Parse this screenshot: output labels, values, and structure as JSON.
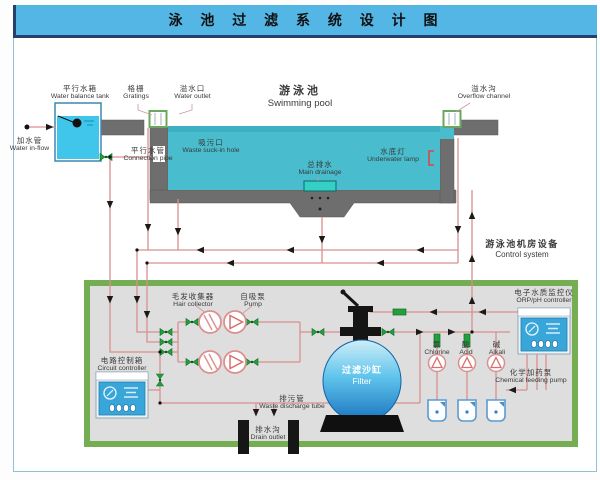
{
  "title": "泳 池 过 滤 系 统 设 计 图",
  "labels": {
    "balance_tank": {
      "cn": "平行水箱",
      "en": "Water balance tank"
    },
    "water_inflow": {
      "cn": "加水管",
      "en": "Water in-flow"
    },
    "gratings": {
      "cn": "格栅",
      "en": "Gratings"
    },
    "water_outlet": {
      "cn": "溢水口",
      "en": "Water outlet"
    },
    "swimming_pool": {
      "cn": "游泳池",
      "en": "Swimming pool"
    },
    "overflow_channel": {
      "cn": "溢水沟",
      "en": "Overflow channel"
    },
    "waste_suckin": {
      "cn": "吸污口",
      "en": "Waste suck-in hole"
    },
    "connection_pipe": {
      "cn": "平行水管",
      "en": "Connection pipe"
    },
    "main_drainage": {
      "cn": "总排水",
      "en": "Main drainage"
    },
    "underwater_lamp": {
      "cn": "水底灯",
      "en": "Underwater lamp"
    },
    "control_system": {
      "cn": "游泳池机房设备",
      "en": "Control system"
    },
    "hair_collector": {
      "cn": "毛发收集器",
      "en": "Hair collector"
    },
    "pump": {
      "cn": "自吸泵",
      "en": "Pump"
    },
    "circuit_controller": {
      "cn": "电路控制箱",
      "en": "Circuit controller"
    },
    "filter": {
      "cn": "过滤沙缸",
      "en": "Filter"
    },
    "chlorine": {
      "cn": "氯",
      "en": "Chlorine"
    },
    "acid": {
      "cn": "酸",
      "en": "Acid"
    },
    "alkali": {
      "cn": "碱",
      "en": "Alkali"
    },
    "chemical_feeding_pump": {
      "cn": "化学加药泵",
      "en": "Chemical feeding pump"
    },
    "orp_controller": {
      "cn": "电子水质监控仪",
      "en": "ORP/pH controller"
    },
    "waste_discharge": {
      "cn": "排污管",
      "en": "Waste discharge tube"
    },
    "drain_outlet": {
      "cn": "排水沟",
      "en": "Drain outlet"
    }
  },
  "colors": {
    "titlebar": "#54b6e4",
    "pool_water": "#49bccd",
    "pool_wall": "#6e6e6e",
    "machine_room_border": "#74ad52",
    "machine_room_bg": "#dedede",
    "pipe": "#d98f8f",
    "valve_green": "#23a03c",
    "device_blue": "#39a6da",
    "filter_gradient_bottom": "#1a74be"
  }
}
